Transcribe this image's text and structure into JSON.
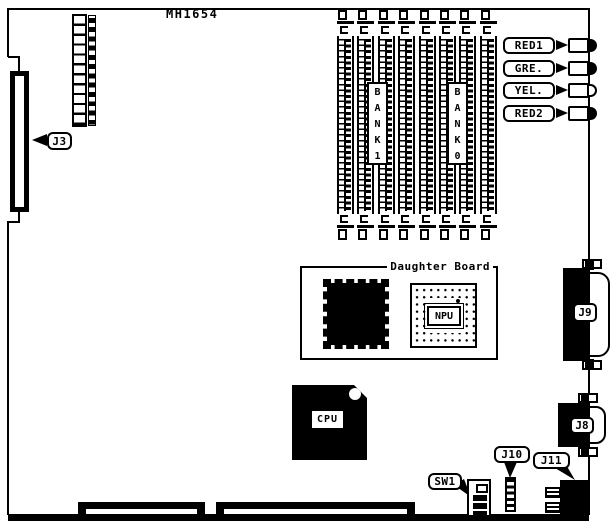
{
  "diagram": {
    "part_number": "MH1654",
    "ink_color": "#000000",
    "paper_color": "#ffffff",
    "callouts": {
      "j3": "J3",
      "sw1": "SW1",
      "j10": "J10",
      "j11": "J11"
    },
    "connectors": {
      "j9": "J9",
      "j8": "J8"
    },
    "leds": [
      {
        "label": "RED1",
        "filled": true
      },
      {
        "label": "GRE.",
        "filled": true
      },
      {
        "label": "YEL.",
        "filled": false
      },
      {
        "label": "RED2",
        "filled": true
      }
    ],
    "memory": {
      "slot_count": 8,
      "bank_labels": [
        {
          "id": "bank1",
          "text": "B\nA\nN\nK\n1"
        },
        {
          "id": "bank0",
          "text": "B\nA\nN\nK\n0"
        }
      ]
    },
    "daughter_board": {
      "title": "Daughter Board",
      "npu_label": "NPU"
    },
    "cpu_label": "CPU"
  }
}
